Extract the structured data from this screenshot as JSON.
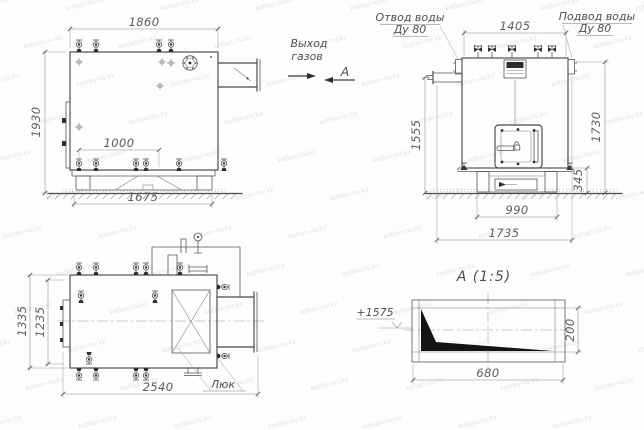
{
  "watermark": {
    "text": "kotlan-nv.kz"
  },
  "side_view": {
    "dim_width_top": "1860",
    "dim_height": "1930",
    "dim_bottom_connections": "1000",
    "dim_base_width": "1675",
    "label_gas_outlet_line1": "Выход",
    "label_gas_outlet_line2": "газов",
    "section_letter": "А"
  },
  "front_view": {
    "label_water_outlet_line1": "Отвод воды",
    "label_water_outlet_line2": "Ду 80",
    "label_water_inlet_line1": "Подвод воды",
    "label_water_inlet_line2": "Ду 80",
    "dim_width_top": "1405",
    "dim_height_left": "1555",
    "dim_height_right": "1730",
    "dim_base_height": "345",
    "dim_base_width": "990",
    "dim_total_depth": "1735"
  },
  "plan_view": {
    "dim_width_outer": "1335",
    "dim_width_inner": "1235",
    "dim_length": "2540",
    "label_hatch": "Люк"
  },
  "section_view": {
    "title": "А (1:5)",
    "dim_width": "680",
    "dim_height": "200",
    "label_elevation": "+1575"
  }
}
